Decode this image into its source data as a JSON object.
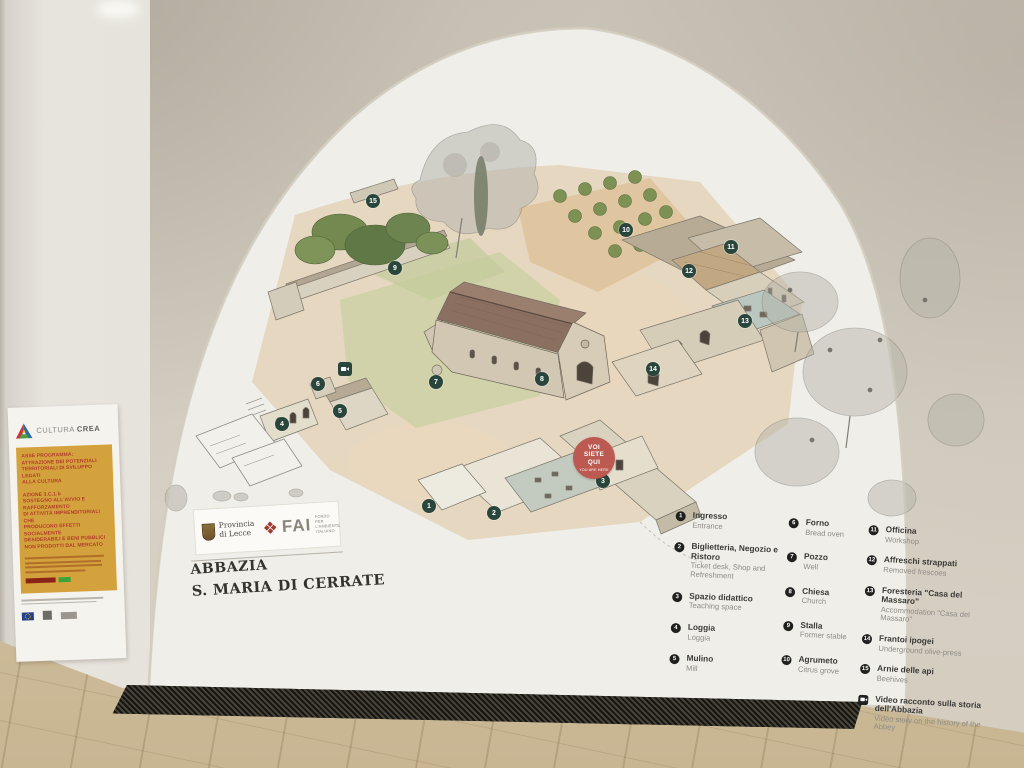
{
  "colors": {
    "marker": "#2a463c",
    "legendnum": "#20201e",
    "balloon": "#bc5a52",
    "fai": "#a23b31",
    "gold": "#d4a23c",
    "posterRed": "#b23a2c",
    "itText": "#3b3a36",
    "enText": "#8f8c85",
    "titleText": "#35332e"
  },
  "mural": {
    "title": {
      "line1": "ABBAZIA",
      "line2": "S. MARIA DI CERRATE"
    },
    "logos": {
      "provincia_line1": "Provincia",
      "provincia_line2": "di Lecce",
      "fai_mark": "❖",
      "fai_acronym": "FAI",
      "fai_sub1": "FONDO",
      "fai_sub2": "PER L'AMBIENTE",
      "fai_sub3": "ITALIANO"
    },
    "you_are_here": {
      "l1": "VOI",
      "l2": "SIETE",
      "l3": "QUI",
      "sub": "YOU ARE HERE"
    }
  },
  "map": {
    "markers": [
      {
        "num": "1",
        "x": 429,
        "y": 506
      },
      {
        "num": "2",
        "x": 494,
        "y": 513
      },
      {
        "num": "3",
        "x": 603,
        "y": 481
      },
      {
        "num": "4",
        "x": 282,
        "y": 424
      },
      {
        "num": "5",
        "x": 340,
        "y": 411
      },
      {
        "num": "6",
        "x": 318,
        "y": 384
      },
      {
        "num": "7",
        "x": 436,
        "y": 382
      },
      {
        "num": "8",
        "x": 542,
        "y": 379
      },
      {
        "num": "9",
        "x": 395,
        "y": 268
      },
      {
        "num": "10",
        "x": 626,
        "y": 230
      },
      {
        "num": "11",
        "x": 731,
        "y": 247
      },
      {
        "num": "12",
        "x": 689,
        "y": 271
      },
      {
        "num": "13",
        "x": 745,
        "y": 321
      },
      {
        "num": "14",
        "x": 653,
        "y": 369
      },
      {
        "num": "15",
        "x": 373,
        "y": 201
      }
    ],
    "video_marker": {
      "x": 345,
      "y": 369
    }
  },
  "legend": {
    "columns": [
      {
        "items": [
          {
            "num": "1",
            "it": "Ingresso",
            "en": "Entrance"
          },
          {
            "num": "2",
            "it": "Biglietteria, Negozio e Ristoro",
            "en": "Ticket desk, Shop and Refreshment"
          },
          {
            "num": "3",
            "it": "Spazio didattico",
            "en": "Teaching space"
          },
          {
            "num": "4",
            "it": "Loggia",
            "en": "Loggia"
          },
          {
            "num": "5",
            "it": "Mulino",
            "en": "Mill"
          }
        ]
      },
      {
        "items": [
          {
            "num": "6",
            "it": "Forno",
            "en": "Bread oven"
          },
          {
            "num": "7",
            "it": "Pozzo",
            "en": "Well"
          },
          {
            "num": "8",
            "it": "Chiesa",
            "en": "Church"
          },
          {
            "num": "9",
            "it": "Stalla",
            "en": "Former stable"
          },
          {
            "num": "10",
            "it": "Agrumeto",
            "en": "Citrus grove"
          }
        ]
      },
      {
        "items": [
          {
            "num": "11",
            "it": "Officina",
            "en": "Workshop"
          },
          {
            "num": "12",
            "it": "Affreschi strappati",
            "en": "Removed frescoes"
          },
          {
            "num": "13",
            "it": "Foresteria \"Casa del Massaro\"",
            "en": "Accommodation \"Casa del Massaro\""
          },
          {
            "num": "14",
            "it": "Frantoi ipogei",
            "en": "Underground olive-press"
          },
          {
            "num": "15",
            "it": "Arnie delle api",
            "en": "Beehives"
          },
          {
            "icon": "video",
            "it": "Video racconto sulla storia dell'Abbazia",
            "en": "Video story on the history of the Abbey"
          }
        ]
      }
    ]
  },
  "poster": {
    "brand_prefix": "CULTURA ",
    "brand_suffix": "CREA",
    "para1": "ASSE PROGRAMMA:\nATTRAZIONE DEI POTENZIALI\nTERRITORIALI DI SVILUPPO LEGATI\nALLA CULTURA",
    "para2": "AZIONE 3.C.1.b\nSOSTEGNO ALL'AVVIO E RAFFORZAMENTO\nDI ATTIVITÀ IMPRENDITORIALI CHE\nPRODUCONO EFFETTI SOCIALMENTE\nDESIDERABILI E BENI PUBBLICI\nNON PRODOTTI DAL MERCATO"
  }
}
